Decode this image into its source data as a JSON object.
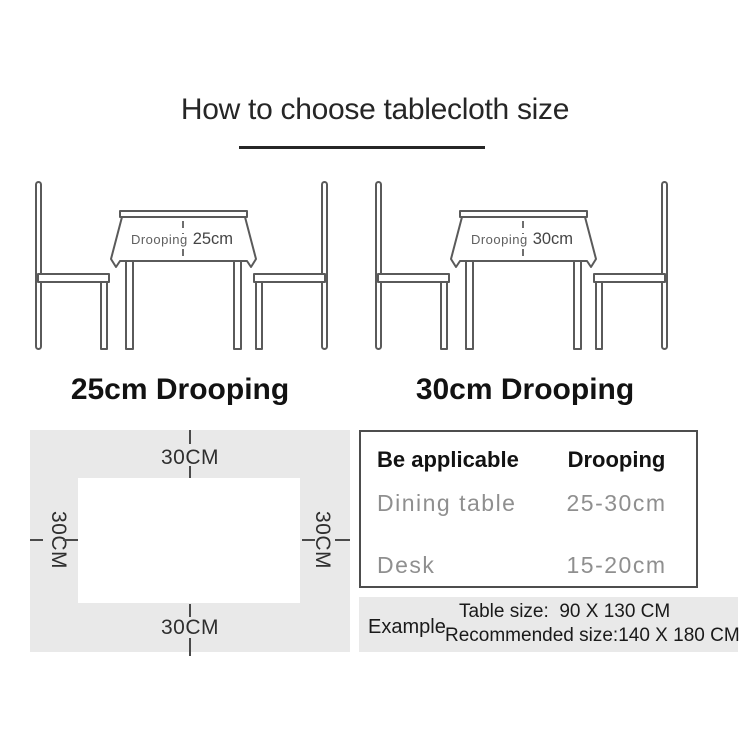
{
  "title": "How to choose tablecloth size",
  "illustrations": [
    {
      "drooping_prefix": "Drooping",
      "drooping_value": "25cm",
      "caption": "25cm Drooping"
    },
    {
      "drooping_prefix": "Drooping",
      "drooping_value": "30cm",
      "caption": "30cm Drooping"
    }
  ],
  "size_diagram": {
    "top_label": "30CM",
    "bottom_label": "30CM",
    "left_label": "30CM",
    "right_label": "30CM"
  },
  "spec_table": {
    "header": {
      "col1": "Be applicable",
      "col2": "Drooping"
    },
    "rows": [
      {
        "col1": "Dining table",
        "col2": "25-30cm"
      },
      {
        "col1": "Desk",
        "col2": "15-20cm"
      }
    ]
  },
  "example": {
    "label": "Example",
    "table_size_line": "Table size:  90 X 130 CM",
    "recommended_line": "Recommended size:140 X 180 CM"
  },
  "colors": {
    "line_art": "#5a5a5a",
    "panel_gray": "#e9e9e9",
    "muted_text": "#8f8f8f",
    "ink": "#262626"
  }
}
